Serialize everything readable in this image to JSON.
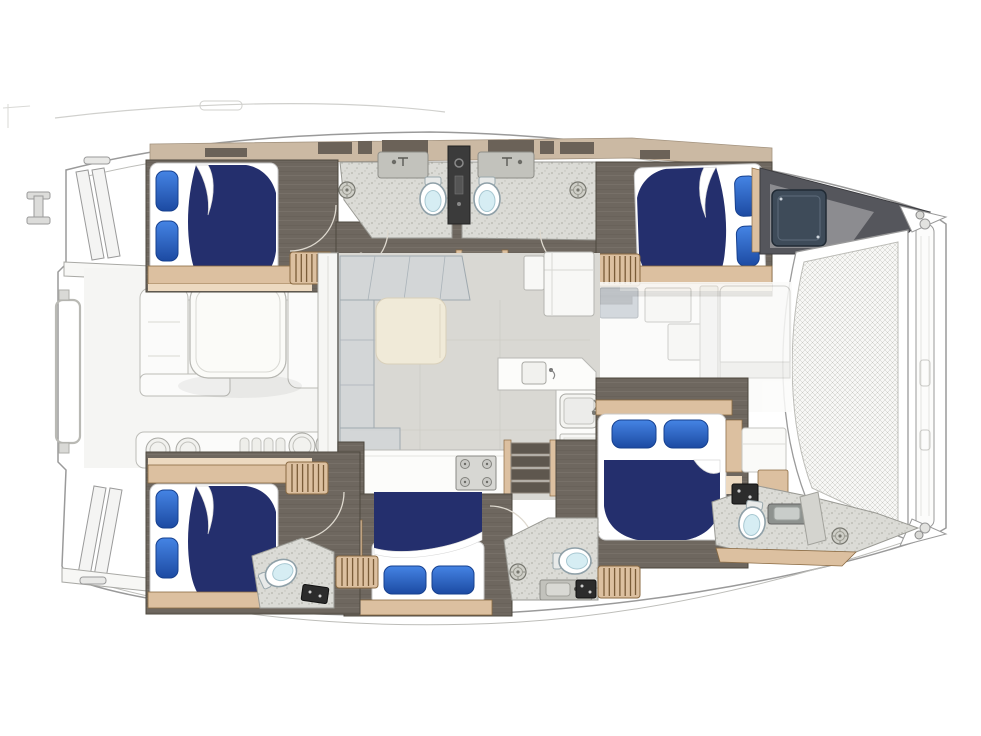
{
  "scene": {
    "kind": "catamaran-yacht-deck-plan",
    "view": "top-down floor plan illustration",
    "width": 981,
    "height": 736,
    "background": "#ffffff"
  },
  "inventory": {
    "double_berths": 5,
    "heads_toilets": 5,
    "bathroom_sinks": 4,
    "shower_drains": 4,
    "companionway_ladders": 4,
    "stairwells": 2,
    "saloon_sofa": 1,
    "saloon_table": 1,
    "galley_sink": 1,
    "stove_burners": 4,
    "cockpit_lounge_table": 1,
    "trampoline_net": 1,
    "bow_crossbeam": 1,
    "transom_step_platforms": 2,
    "mooring_cleats": 3,
    "deck_hatches": 7
  },
  "palette": {
    "hullFill": "#ffffff",
    "hullLine": "#9a9a9a",
    "ghostFill": "#fbfbfa",
    "ghostLine": "#bcbcb7",
    "tanDeck": "#cbb9a3",
    "tanEdge": "#a3937f",
    "tanInset": "#6b6258",
    "floorDark": "#6e675f",
    "floorEdge": "#4e483f",
    "plankLine": "#7a7265",
    "wood": "#dcc0a0",
    "woodEdge": "#8a6a42",
    "woodLight": "#ecd9c0",
    "ladderLine": "#7a5c38",
    "speckBg": "#dbdbd6",
    "speckDot": "#b3b3ac",
    "speckEdge": "#9a9a94",
    "saloonFloor": "#d9d8d3",
    "panelLine": "#c7c6c0",
    "navy": "#242f6d",
    "pillowTop": "#4584e4",
    "pillowBot": "#1c4aa2",
    "pillowEdge": "#16408f",
    "sofaFill": "#cdd5da",
    "sofaLine": "#9fa9af",
    "cream": "#f0ead8",
    "creamEdge": "#d9d0ba",
    "counter": "#fcfcfa",
    "counterLine": "#b9b9b4",
    "stove": "#d7d7d3",
    "stoveLine": "#8a8a85",
    "stair": "#5e574e",
    "stairLine": "#8d857a",
    "sinkGray": "#c2c2bc",
    "sinkLine": "#8e8e88",
    "fixtureDark": "#2c2c2c",
    "bowl": "#d6edf3",
    "toiletLine": "#8fa0a8",
    "drainFill": "#cfcfc8",
    "drainLine": "#77776f",
    "meshBg": "#f7f7f5",
    "meshLine": "#c9c9c4",
    "darkWedge": "#55565c",
    "darkWedgeIn": "#8c8c90",
    "hatchSq": "#3e4b59",
    "hatchSqLine": "#202a34",
    "arcLine": "#ded9cf"
  }
}
